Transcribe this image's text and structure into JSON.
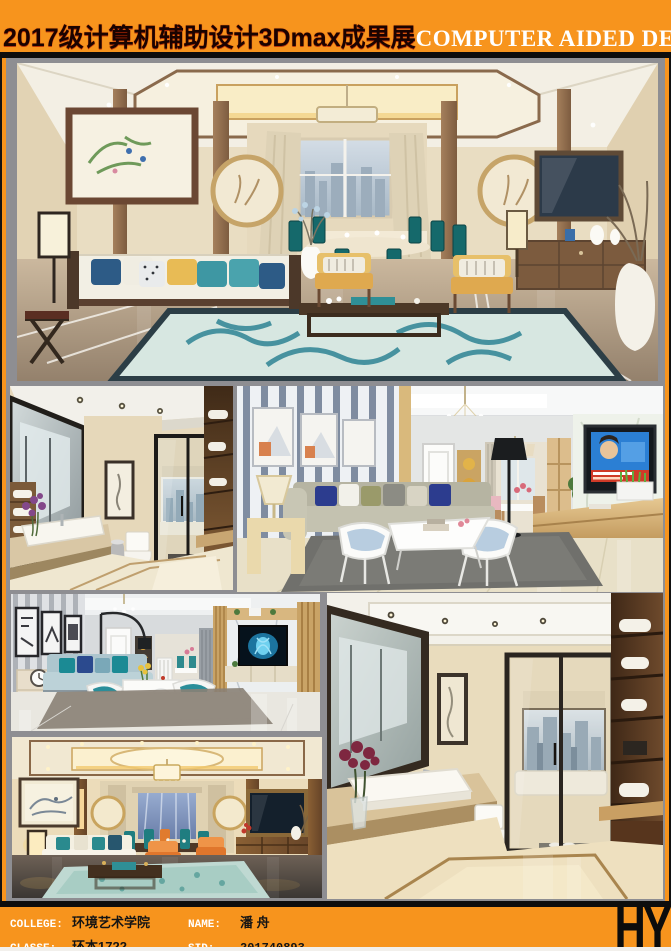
{
  "header": {
    "title_zh": "2017级计算机辅助设计3Dmax成果展",
    "title_en": "COMPUTER AIDED DESIGN"
  },
  "footer": {
    "college_label": "COLLEGE:",
    "college_value": "环境艺术学院",
    "classe_label": "CLASSE:",
    "classe_value": "环本1722",
    "name_label": "NAME:",
    "name_value": "潘 舟",
    "sid_label": "SID:",
    "sid_value": "201740893",
    "logo": "HY"
  },
  "gallery": {
    "photos": [
      {
        "name": "living-room-new-chinese",
        "description": "New Chinese style living and dining room render with framed bird painting, white sofa, yellow armchairs, teal swirl rug and city-view window"
      },
      {
        "name": "bathroom-wood",
        "description": "Bathroom render with wood shelving, framed mirror, white basin, toilet and black-framed glass partition with city window"
      },
      {
        "name": "living-room-modern-striped",
        "description": "Modern living room render with striped feature wall, crystal chandelier, gray sofa with blue pillows, white coffee table and wall TV"
      },
      {
        "name": "living-room-blue-accent",
        "description": "Living room render with black and white prints, arc floor lamp, light blue sofa, teal chairs and marble TV wall with glowing blue art"
      },
      {
        "name": "bathroom-marble",
        "description": "Large marble bathroom render with big mirror, white vessel sink, burgundy flowers, glass sliding door, bathtub and city-view window"
      },
      {
        "name": "living-room-warm-chinese",
        "description": "Warm evening Chinese style living room render with lantern lamps, landscape painting, orange armchairs, teal rug and wall TV"
      }
    ]
  },
  "colors": {
    "accent_orange": "#F7941D",
    "board_gray": "#8E8E92",
    "rule_black": "#0D0D0D",
    "title_en_white": "#FFFFFF"
  }
}
